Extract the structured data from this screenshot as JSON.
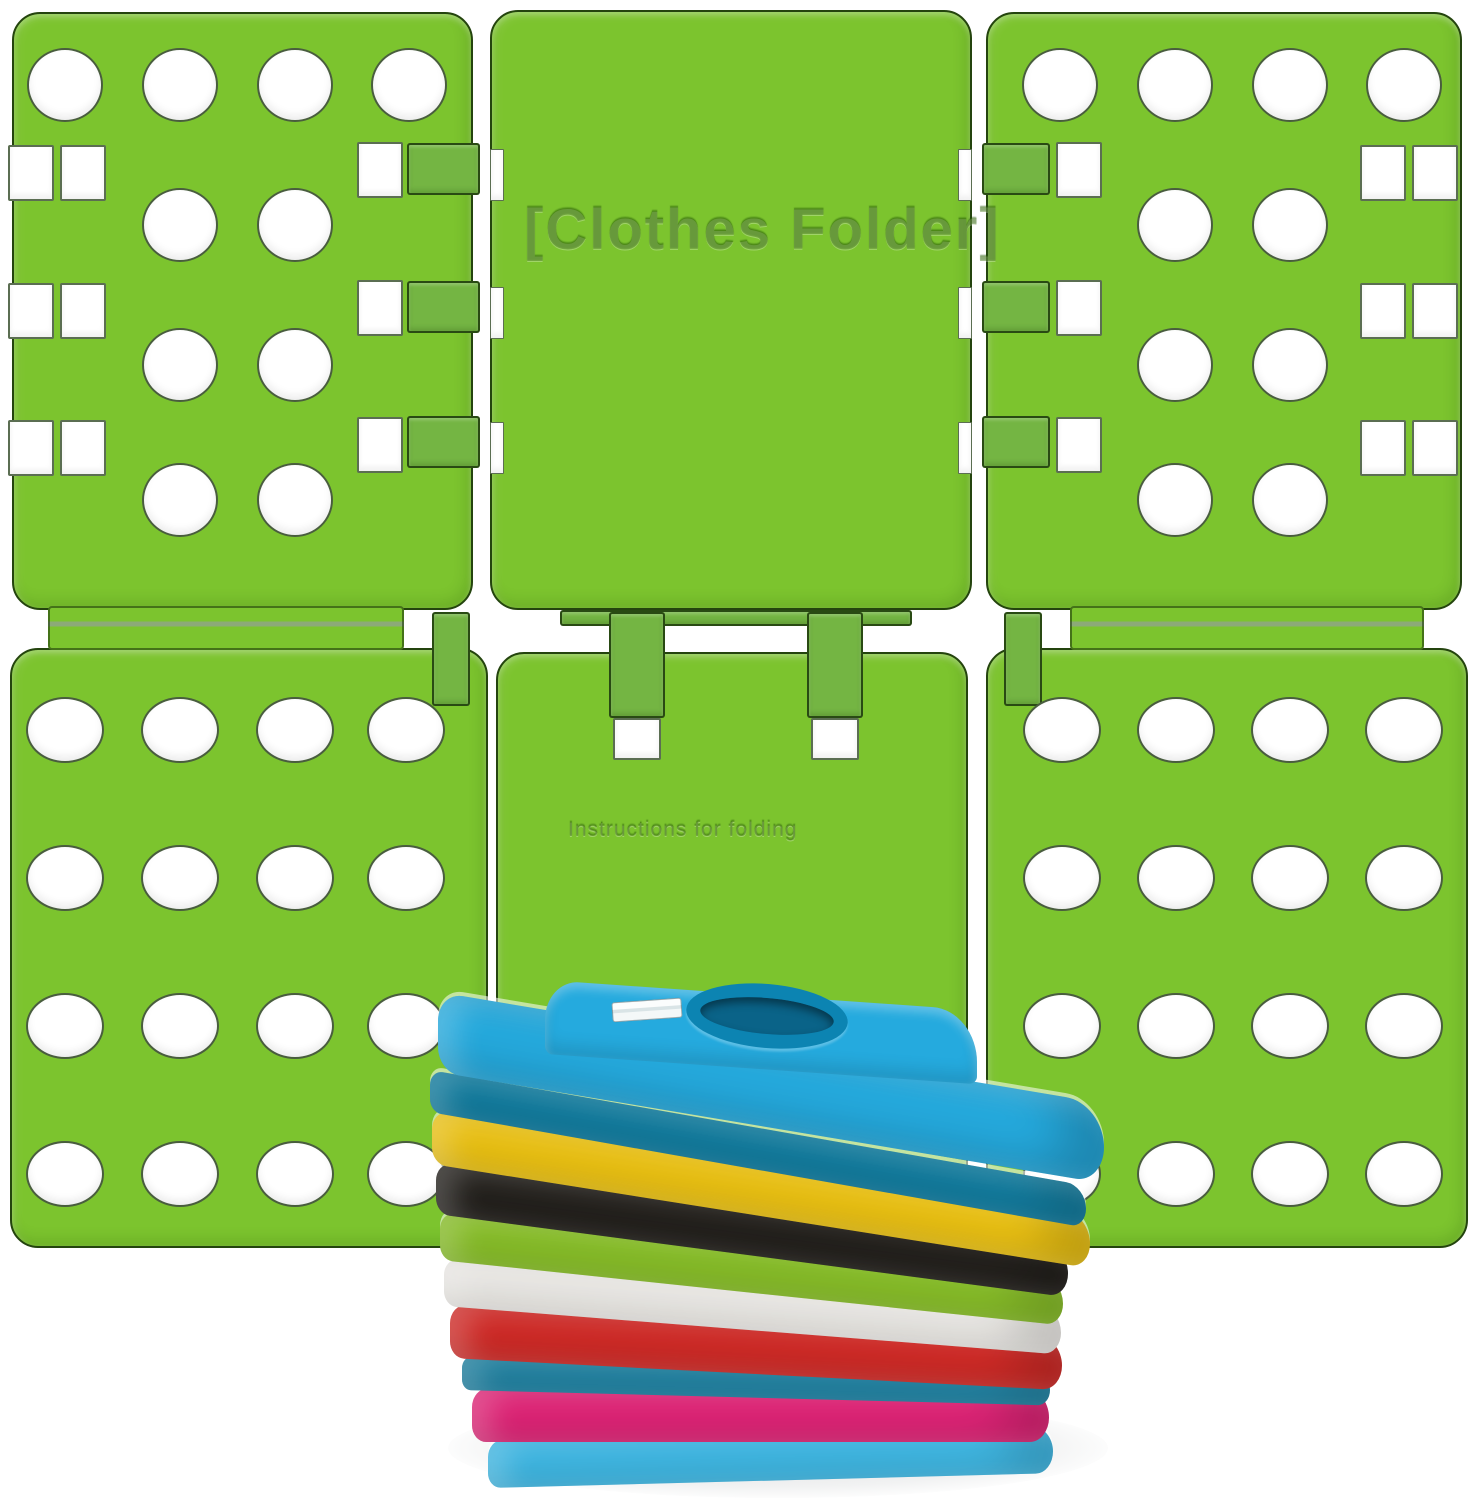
{
  "meta": {
    "description": "Product photo: green plastic t-shirt folding board (flip-fold laundry folder) made of six hinged perforated panels, shown behind a stack of nine folded t-shirts on a white surface"
  },
  "board": {
    "embossed_title": "[Clothes Folder]",
    "embossed_instructions": "Instructions for folding"
  },
  "colors": {
    "bg": "#ffffff",
    "board-green": "#7cc42e",
    "tab-green": "#74b543",
    "outline": "#24440e",
    "hole-white": "#ffffff",
    "collar-ring": "#0c84b2",
    "collar-inner": "#0a6388"
  },
  "shirts": [
    {
      "name": "sky-blue-top",
      "color": "#25aade"
    },
    {
      "name": "teal-fold-upper",
      "color": "#0e7fa4"
    },
    {
      "name": "yellow",
      "color": "#f2c713"
    },
    {
      "name": "black",
      "color": "#23201c"
    },
    {
      "name": "lime-green",
      "color": "#8bc427"
    },
    {
      "name": "white",
      "color": "#f4f2ee"
    },
    {
      "name": "red",
      "color": "#d62b27"
    },
    {
      "name": "teal-fold-lower",
      "color": "#1b85a8"
    },
    {
      "name": "magenta",
      "color": "#e52479"
    },
    {
      "name": "light-blue",
      "color": "#3fbdeb"
    }
  ]
}
